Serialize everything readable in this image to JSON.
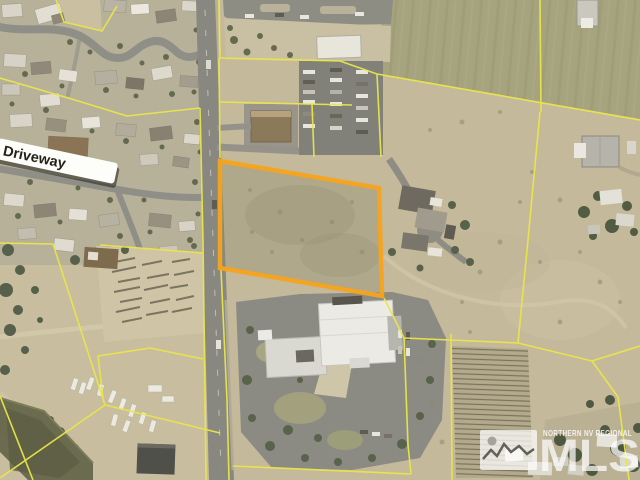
{
  "map": {
    "kind": "aerial-parcel-view",
    "road_label": "Driveway",
    "highlighted_parcel": {
      "points": "220,161 379,188 382,296 220,268",
      "outline_color": "#F5A31C"
    },
    "boundary_line_color": "#E9E64A",
    "watermark": {
      "agency": "NORTHERN NV REGIONAL",
      "logo": "MLS",
      "color": "#FFFFFF"
    }
  }
}
